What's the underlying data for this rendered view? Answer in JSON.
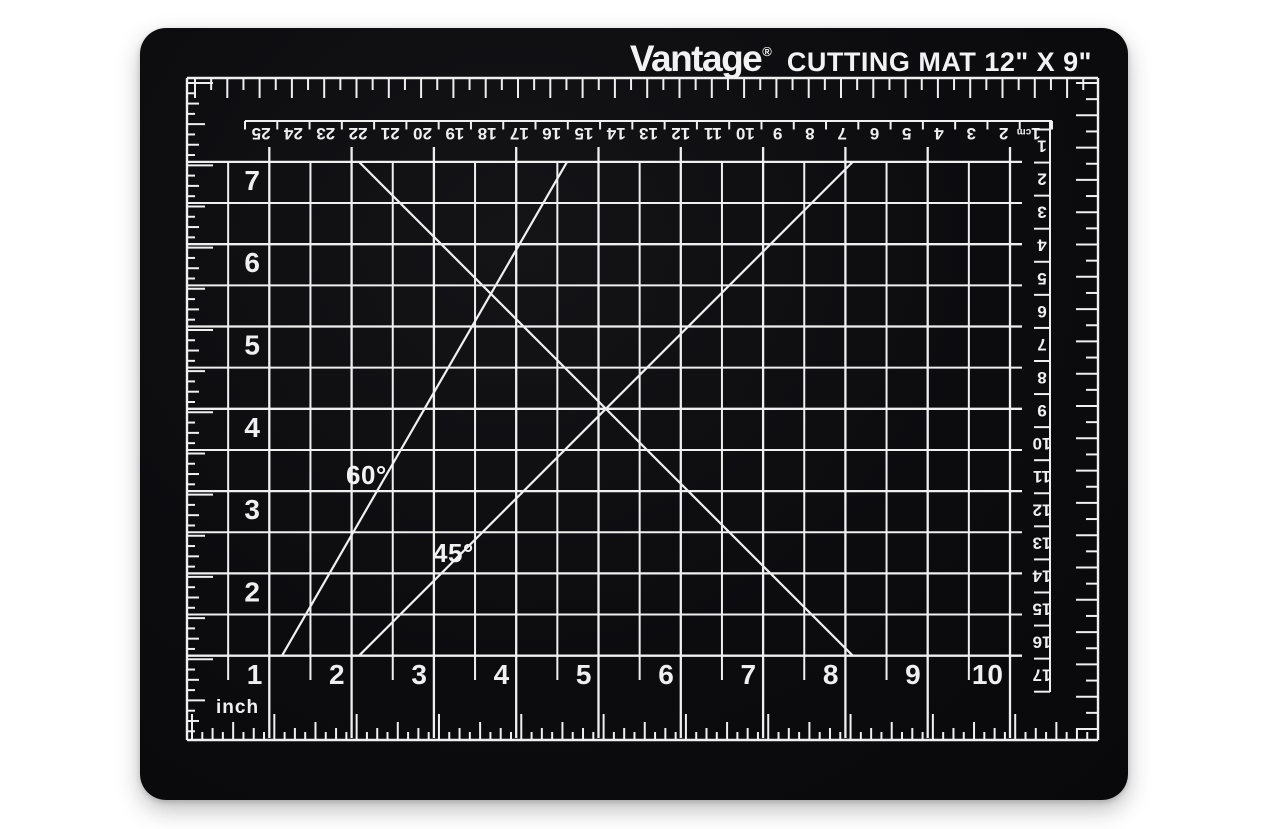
{
  "product": {
    "brand": "Vantage",
    "registered_mark": "®",
    "title": "CUTTING MAT 12\" X 9\""
  },
  "colors": {
    "background": "#ffffff",
    "mat": "#0c0c0f",
    "markings": "#efeff0"
  },
  "labels": {
    "sixty": "60°",
    "fortyfive": "45°",
    "inch_unit": "inch"
  },
  "top_cm_ruler": {
    "unit_label": "cm",
    "numbers": [
      25,
      24,
      23,
      22,
      21,
      20,
      19,
      18,
      17,
      16,
      15,
      14,
      13,
      12,
      11,
      10,
      9,
      8,
      7,
      6,
      5,
      4,
      3,
      2,
      1
    ]
  },
  "right_cm_ruler": {
    "numbers": [
      1,
      2,
      3,
      4,
      5,
      6,
      7,
      8,
      9,
      10,
      11,
      12,
      13,
      14,
      15,
      16,
      17
    ]
  },
  "grid": {
    "left_labels": [
      7,
      6,
      5,
      4,
      3,
      2
    ],
    "bottom_labels": [
      1,
      2,
      3,
      4,
      5,
      6,
      7,
      8,
      9,
      10
    ]
  }
}
